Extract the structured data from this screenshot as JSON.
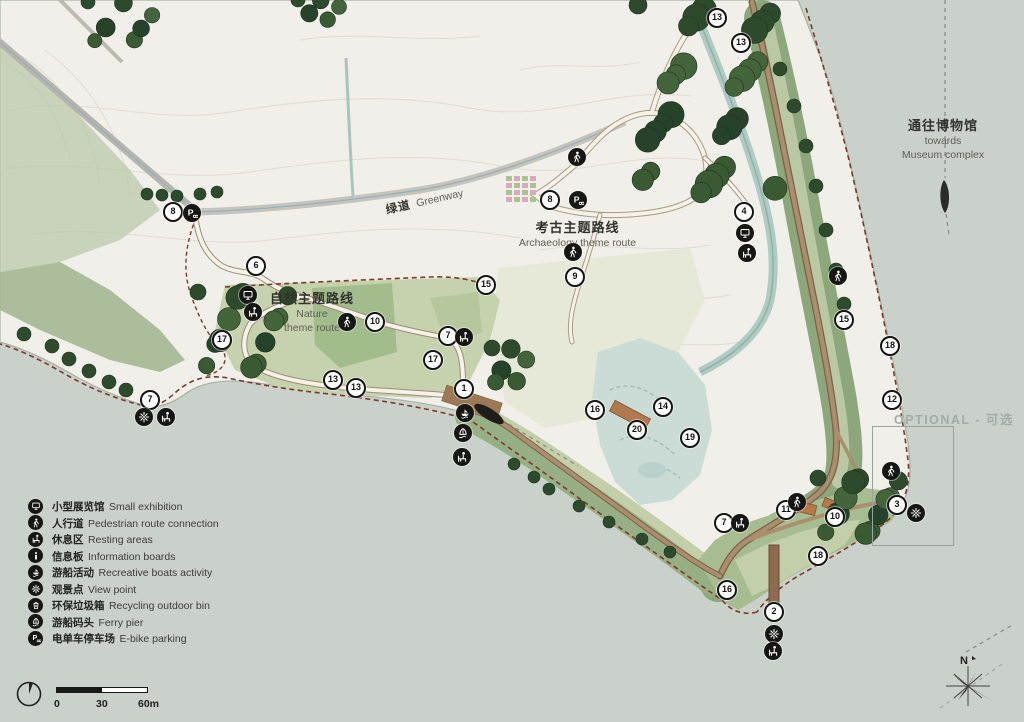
{
  "labels": {
    "greenway": {
      "zh": "绿道",
      "en": "Greenway"
    },
    "nature_route": {
      "zh": "自然主题路线",
      "en1": "Nature",
      "en2": "theme route"
    },
    "archaeology_route": {
      "zh": "考古主题路线",
      "en": "Archaeology theme route"
    },
    "museum": {
      "zh": "通往博物馆",
      "en1": "towards",
      "en2": "Museum complex"
    },
    "optional": {
      "text": "OPTIONAL - 可选"
    }
  },
  "legend": {
    "items": [
      {
        "icon": "exhibition",
        "zh": "小型展览馆",
        "en": "Small exhibition"
      },
      {
        "icon": "walker",
        "zh": "人行道",
        "en": "Pedestrian route connection"
      },
      {
        "icon": "resting",
        "zh": "休息区",
        "en": "Resting areas"
      },
      {
        "icon": "info",
        "zh": "信息板",
        "en": "Information boards"
      },
      {
        "icon": "boats",
        "zh": "游船活动",
        "en": "Recreative boats activity"
      },
      {
        "icon": "view",
        "zh": "观景点",
        "en": "View point"
      },
      {
        "icon": "bin",
        "zh": "环保垃圾箱",
        "en": "Recycling outdoor bin"
      },
      {
        "icon": "ferry",
        "zh": "游船码头",
        "en": "Ferry pier"
      },
      {
        "icon": "pbike",
        "zh": "电单车停车场",
        "en": "E-bike parking"
      }
    ]
  },
  "scale_bar": {
    "ticks": [
      "0",
      "30",
      "60m"
    ]
  },
  "north": {
    "label": "N"
  },
  "markers": [
    {
      "n": "13",
      "x": 717,
      "y": 18
    },
    {
      "n": "13",
      "x": 741,
      "y": 43
    },
    {
      "n": "8",
      "x": 173,
      "y": 212
    },
    {
      "n": "8",
      "x": 550,
      "y": 200
    },
    {
      "n": "6",
      "x": 256,
      "y": 266
    },
    {
      "n": "4",
      "x": 744,
      "y": 212
    },
    {
      "n": "15",
      "x": 486,
      "y": 285
    },
    {
      "n": "15",
      "x": 844,
      "y": 320
    },
    {
      "n": "10",
      "x": 375,
      "y": 322
    },
    {
      "n": "7",
      "x": 448,
      "y": 336
    },
    {
      "n": "17",
      "x": 222,
      "y": 340
    },
    {
      "n": "17",
      "x": 433,
      "y": 360
    },
    {
      "n": "18",
      "x": 890,
      "y": 346
    },
    {
      "n": "13",
      "x": 333,
      "y": 380
    },
    {
      "n": "13",
      "x": 356,
      "y": 388
    },
    {
      "n": "1",
      "x": 464,
      "y": 389
    },
    {
      "n": "12",
      "x": 892,
      "y": 400
    },
    {
      "n": "7",
      "x": 150,
      "y": 400
    },
    {
      "n": "16",
      "x": 595,
      "y": 410
    },
    {
      "n": "14",
      "x": 663,
      "y": 407
    },
    {
      "n": "20",
      "x": 637,
      "y": 430
    },
    {
      "n": "19",
      "x": 690,
      "y": 438
    },
    {
      "n": "9",
      "x": 575,
      "y": 277
    },
    {
      "n": "3",
      "x": 897,
      "y": 505
    },
    {
      "n": "11",
      "x": 786,
      "y": 510
    },
    {
      "n": "10",
      "x": 835,
      "y": 517
    },
    {
      "n": "7",
      "x": 724,
      "y": 523
    },
    {
      "n": "18",
      "x": 818,
      "y": 556
    },
    {
      "n": "16",
      "x": 727,
      "y": 590
    },
    {
      "n": "2",
      "x": 774,
      "y": 612
    }
  ],
  "icon_markers": [
    {
      "icon": "pbike",
      "x": 192,
      "y": 213
    },
    {
      "icon": "pbike",
      "x": 578,
      "y": 200
    },
    {
      "icon": "exhibition",
      "x": 248,
      "y": 295
    },
    {
      "icon": "resting",
      "x": 253,
      "y": 312
    },
    {
      "icon": "walker",
      "x": 347,
      "y": 322
    },
    {
      "icon": "resting",
      "x": 464,
      "y": 337
    },
    {
      "icon": "boats",
      "x": 465,
      "y": 413
    },
    {
      "icon": "ferry",
      "x": 463,
      "y": 433
    },
    {
      "icon": "resting",
      "x": 462,
      "y": 457
    },
    {
      "icon": "view",
      "x": 144,
      "y": 417
    },
    {
      "icon": "resting",
      "x": 166,
      "y": 417
    },
    {
      "icon": "exhibition",
      "x": 745,
      "y": 233
    },
    {
      "icon": "resting",
      "x": 747,
      "y": 253
    },
    {
      "icon": "walker",
      "x": 577,
      "y": 157
    },
    {
      "icon": "walker",
      "x": 573,
      "y": 252
    },
    {
      "icon": "walker",
      "x": 838,
      "y": 276
    },
    {
      "icon": "walker",
      "x": 891,
      "y": 471
    },
    {
      "icon": "view",
      "x": 916,
      "y": 513
    },
    {
      "icon": "walker",
      "x": 797,
      "y": 502
    },
    {
      "icon": "resting",
      "x": 740,
      "y": 523
    },
    {
      "icon": "view",
      "x": 774,
      "y": 634
    },
    {
      "icon": "resting",
      "x": 773,
      "y": 651
    }
  ],
  "colors": {
    "water": "#c9d1ca",
    "land": "#f0efe9",
    "park_band": "#8da77c",
    "route_brown": "#a98f6e",
    "dashed_boundary": "#7d3a2a",
    "marker_bg": "#ffffff"
  }
}
